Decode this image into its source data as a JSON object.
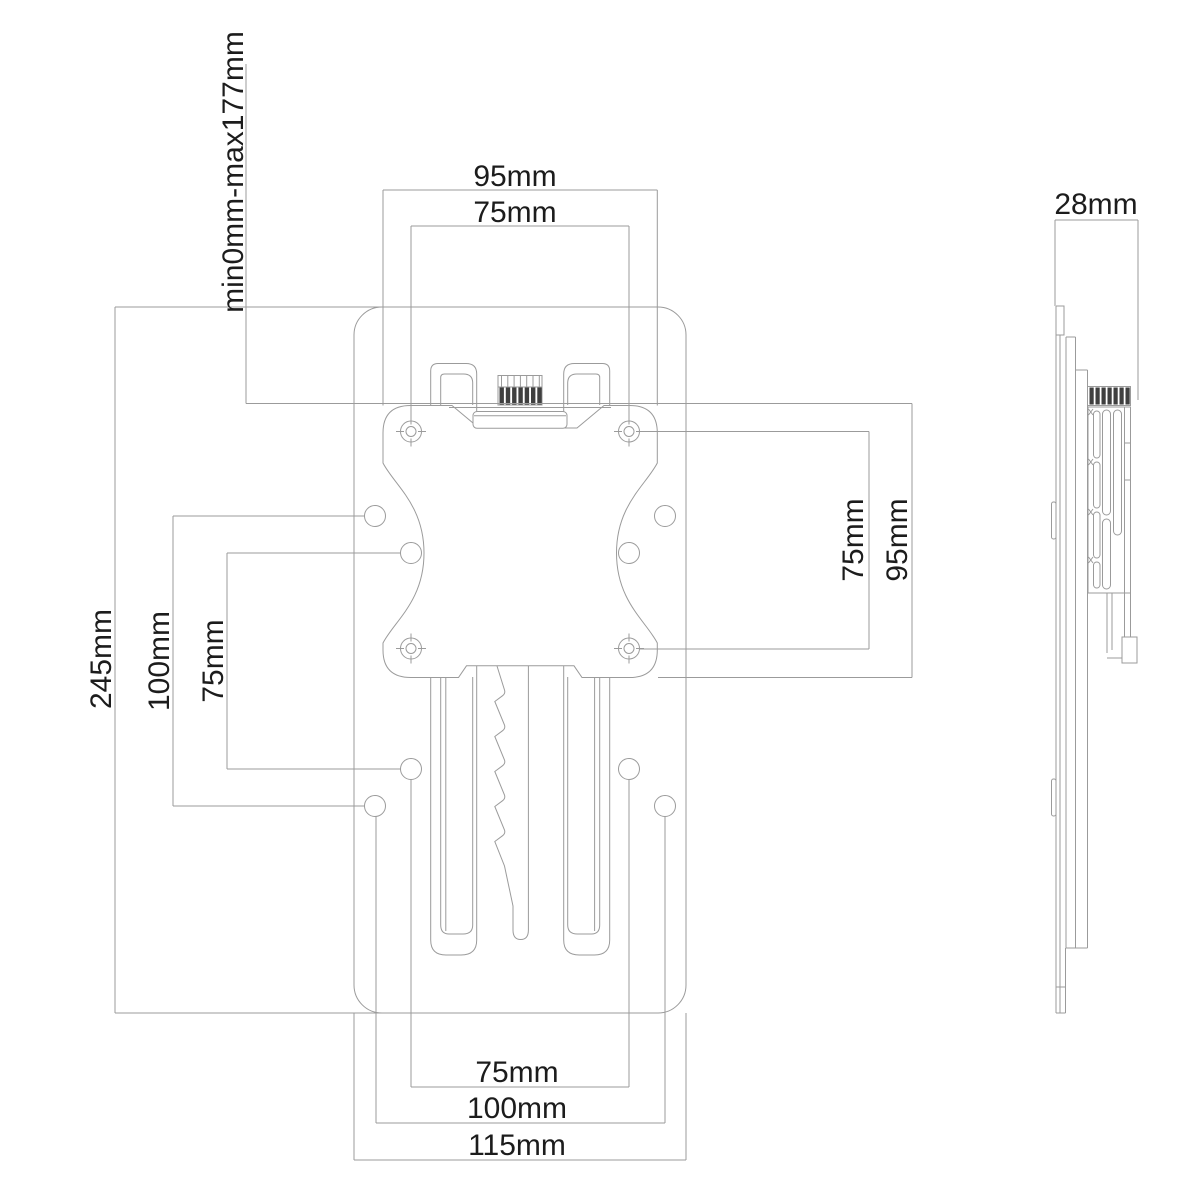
{
  "drawing": {
    "type": "technical-dimension-drawing",
    "subject": "VESA mount adapter, front and side views",
    "colors": {
      "background": "#ffffff",
      "line": "#9b9b9b",
      "text": "#1c1c1c",
      "knob": "#3f3f3f"
    }
  },
  "labels": {
    "adjustment_range": "min0mm-max177mm",
    "vesa_plate_width": "95mm",
    "vesa_holes_horizontal": "75mm",
    "plate_height": "245mm",
    "back_holes_vertical_100": "100mm",
    "back_holes_vertical_75": "75mm",
    "vesa_holes_vertical": "75mm",
    "vesa_plate_height": "95mm",
    "side_depth": "28mm",
    "back_holes_horizontal_75": "75mm",
    "back_holes_horizontal_100": "100mm",
    "plate_width": "115mm"
  }
}
